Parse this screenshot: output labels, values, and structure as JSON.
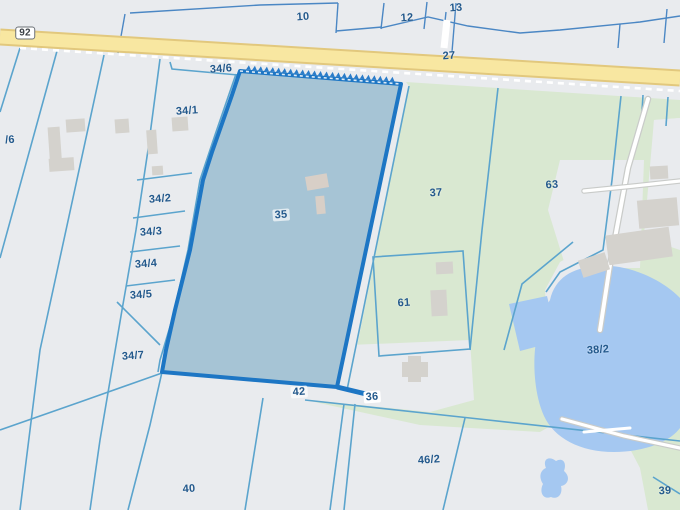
{
  "map": {
    "type": "cadastral-parcel-map",
    "selected_parcel": "35",
    "colors": {
      "parcel_base": "#e9ebee",
      "greenery": "#d9e8d1",
      "water": "#a5c8f1",
      "road_fill": "#f8e7a1",
      "road_casing": "#e2c87d",
      "boundary_teal": "#5ba4cd",
      "boundary_blue": "#4b87c4",
      "selected_stroke": "#1d76c4",
      "selected_fill": "#a6c4d5",
      "building": "#d4d2cd",
      "label_text": "#23598c"
    },
    "labels": [
      {
        "text": "92",
        "x": 25,
        "y": 33,
        "kind": "shield",
        "name": "road-shield-92"
      },
      {
        "text": "10",
        "x": 303,
        "y": 17,
        "name": "parcel-label-10"
      },
      {
        "text": "12",
        "x": 407,
        "y": 18,
        "name": "parcel-label-12"
      },
      {
        "text": "13",
        "x": 456,
        "y": 8,
        "name": "parcel-label-13"
      },
      {
        "text": "27",
        "x": 449,
        "y": 56,
        "name": "parcel-label-27"
      },
      {
        "text": "/6",
        "x": 10,
        "y": 140,
        "name": "parcel-label-6-clipped"
      },
      {
        "text": "34/6",
        "x": 221,
        "y": 69,
        "name": "parcel-label-34-6"
      },
      {
        "text": "34/1",
        "x": 187,
        "y": 111,
        "name": "parcel-label-34-1"
      },
      {
        "text": "34/2",
        "x": 160,
        "y": 199,
        "name": "parcel-label-34-2"
      },
      {
        "text": "34/3",
        "x": 151,
        "y": 232,
        "name": "parcel-label-34-3"
      },
      {
        "text": "34/4",
        "x": 146,
        "y": 264,
        "name": "parcel-label-34-4"
      },
      {
        "text": "34/5",
        "x": 141,
        "y": 295,
        "name": "parcel-label-34-5"
      },
      {
        "text": "34/7",
        "x": 133,
        "y": 356,
        "name": "parcel-label-34-7"
      },
      {
        "text": "35",
        "x": 281,
        "y": 215,
        "kind": "halo",
        "name": "parcel-label-35-selected"
      },
      {
        "text": "37",
        "x": 436,
        "y": 193,
        "name": "parcel-label-37"
      },
      {
        "text": "63",
        "x": 552,
        "y": 185,
        "name": "parcel-label-63"
      },
      {
        "text": "61",
        "x": 404,
        "y": 303,
        "name": "parcel-label-61"
      },
      {
        "text": "38/2",
        "x": 598,
        "y": 350,
        "name": "parcel-label-38-2"
      },
      {
        "text": "42",
        "x": 299,
        "y": 392,
        "kind": "halo",
        "name": "parcel-label-42"
      },
      {
        "text": "36",
        "x": 372,
        "y": 397,
        "kind": "boxed",
        "name": "parcel-label-36"
      },
      {
        "text": "40",
        "x": 189,
        "y": 489,
        "name": "parcel-label-40"
      },
      {
        "text": "46/2",
        "x": 429,
        "y": 460,
        "name": "parcel-label-46-2"
      },
      {
        "text": "39",
        "x": 665,
        "y": 491,
        "name": "parcel-label-39"
      }
    ],
    "selected_parcel_outline": [
      [
        240,
        71
      ],
      [
        401,
        84
      ],
      [
        337,
        387
      ],
      [
        162,
        372
      ],
      [
        166,
        350
      ],
      [
        175,
        310
      ],
      [
        190,
        250
      ],
      [
        203,
        180
      ],
      [
        212,
        152
      ],
      [
        232,
        95
      ]
    ],
    "selected_top_edge": {
      "x1": 240,
      "y1": 71,
      "x2": 401,
      "y2": 84
    }
  }
}
